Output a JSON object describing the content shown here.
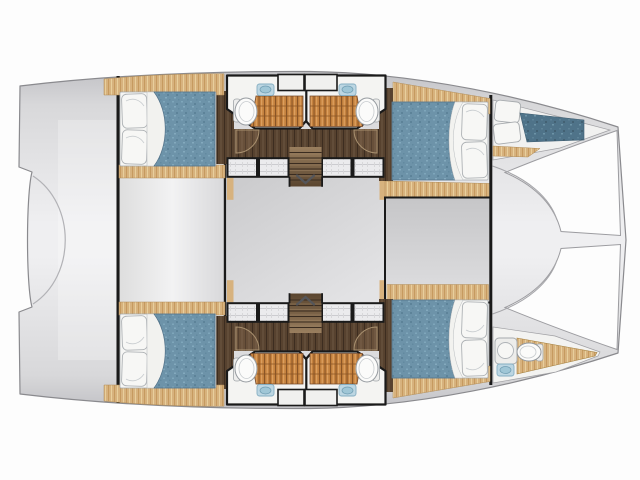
{
  "figure": {
    "type": "floor-plan",
    "subject": "catamaran-yacht-interior-layout-top-view",
    "orientation": "bow-right-stern-left",
    "decks_shown": 1
  },
  "palette": {
    "background": "#fdfdfd",
    "deck_light": "#efeff1",
    "deck_shadow": "#c2c2c6",
    "hull_outline": "#8a8a8e",
    "structure_line": "#1a1a1a",
    "wood_light": "#d7b27e",
    "wood_grain": "#c69a5f",
    "teak_grate": "#c5823f",
    "teak_grate_line": "#8a5526",
    "walnut_floor": "#57422f",
    "walnut_line": "#3d2d20",
    "mattress_blue": "#6d93a9",
    "mattress_blue_dark": "#4f7389",
    "linen_white": "#f7f7f5",
    "fixture_outline": "#9aa0a5",
    "sink_blue": "#bcd6e2",
    "saloon_floor": "#d5d5d7",
    "cockpit_floor": "#eff0f1"
  },
  "spaces": [
    {
      "id": "stern-platform",
      "side": "aft"
    },
    {
      "id": "aft-cockpit",
      "side": "center"
    },
    {
      "id": "saloon",
      "side": "center"
    },
    {
      "id": "forward-cockpit",
      "side": "center"
    },
    {
      "id": "foredeck-beam",
      "side": "forward"
    },
    {
      "id": "port-aft-cabin",
      "side": "port"
    },
    {
      "id": "port-bathroom",
      "side": "port"
    },
    {
      "id": "port-forward-cabin",
      "side": "port"
    },
    {
      "id": "port-bow-berth",
      "side": "port"
    },
    {
      "id": "starboard-aft-cabin",
      "side": "starboard"
    },
    {
      "id": "starboard-bathroom",
      "side": "starboard"
    },
    {
      "id": "starboard-forward-cabin",
      "side": "starboard"
    },
    {
      "id": "starboard-bow-bathroom",
      "side": "starboard"
    }
  ],
  "fixtures": [
    {
      "id": "double-bed",
      "count": 4
    },
    {
      "id": "pillow",
      "count": 10
    },
    {
      "id": "shower-grate",
      "count": 4
    },
    {
      "id": "toilet",
      "count": 5
    },
    {
      "id": "sink",
      "count": 6
    },
    {
      "id": "staircase",
      "count": 2
    },
    {
      "id": "deck-hatch",
      "count": 8
    },
    {
      "id": "door-swing",
      "count": 4
    }
  ]
}
